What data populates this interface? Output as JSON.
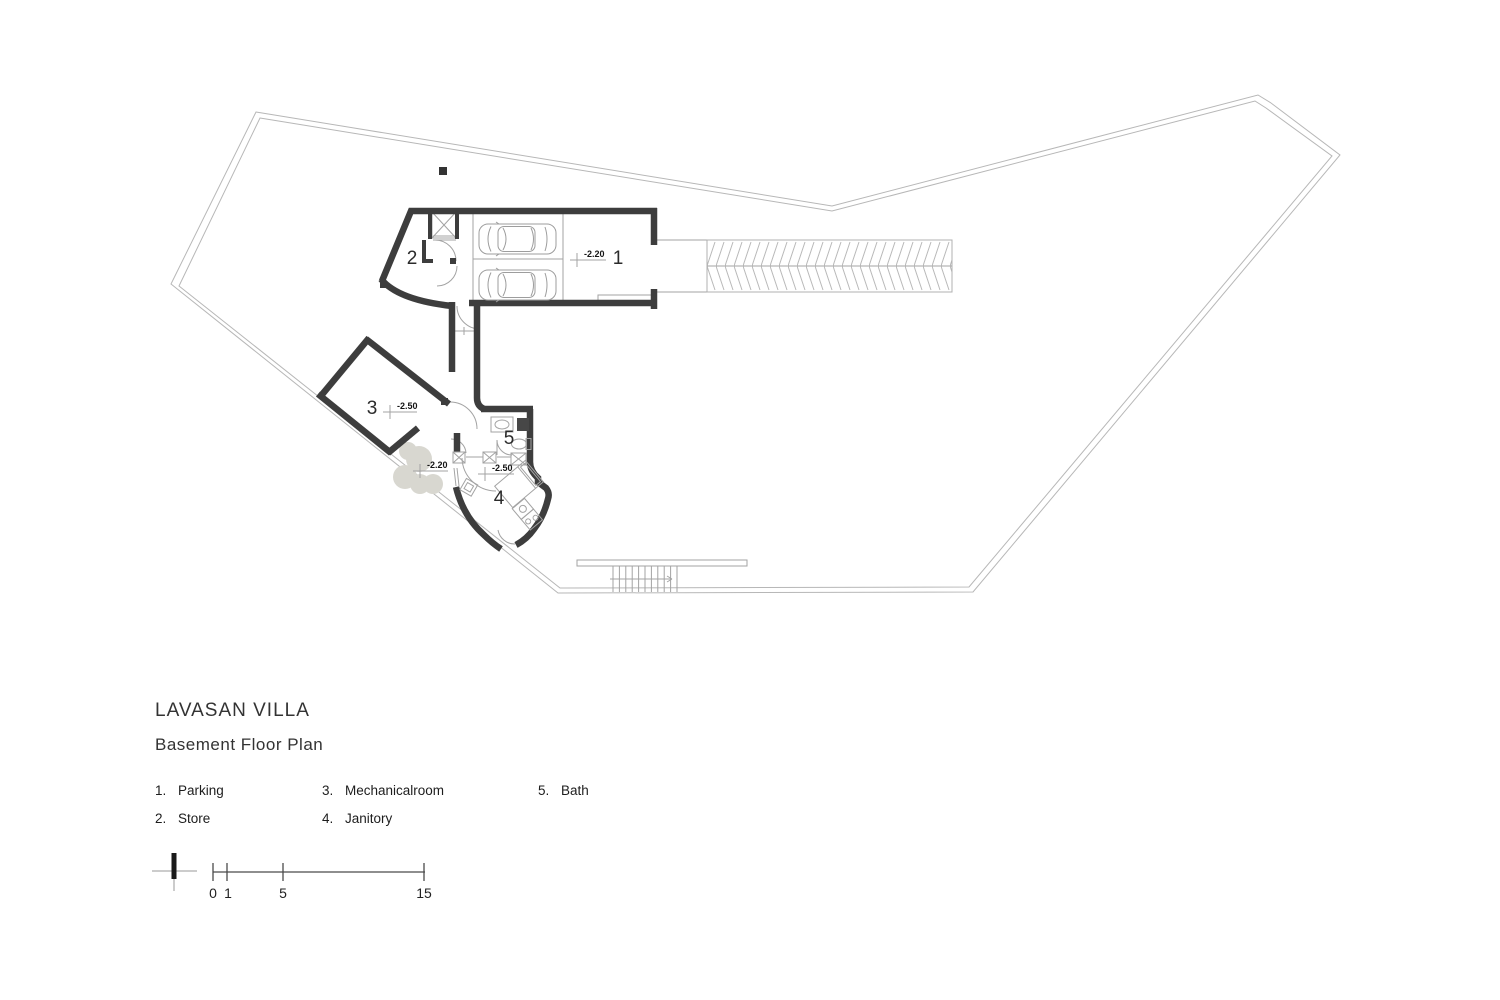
{
  "title": "LAVASAN VILLA",
  "subtitle": "Basement Floor Plan",
  "legend": {
    "items": [
      {
        "num": "1.",
        "label": "Parking"
      },
      {
        "num": "2.",
        "label": "Store"
      },
      {
        "num": "3.",
        "label": "Mechanicalroom"
      },
      {
        "num": "4.",
        "label": "Janitory"
      },
      {
        "num": "5.",
        "label": "Bath"
      }
    ]
  },
  "plan": {
    "room_numbers": {
      "parking": "1",
      "store": "2",
      "mechanical": "3",
      "janitory": "4",
      "bath": "5"
    },
    "levels": {
      "parking": "-2.20",
      "mechanical": "-2.50",
      "terrace": "-2.20",
      "janitory": "-2.50"
    }
  },
  "scalebar": {
    "ticks": [
      "0",
      "1",
      "5",
      "15"
    ]
  },
  "colors": {
    "wall": "#3d3d3d",
    "thin_line": "#a3a3a3",
    "boundary": "#b7b7b7",
    "tree": "#d8d7d0",
    "text": "#1d1d1d"
  }
}
